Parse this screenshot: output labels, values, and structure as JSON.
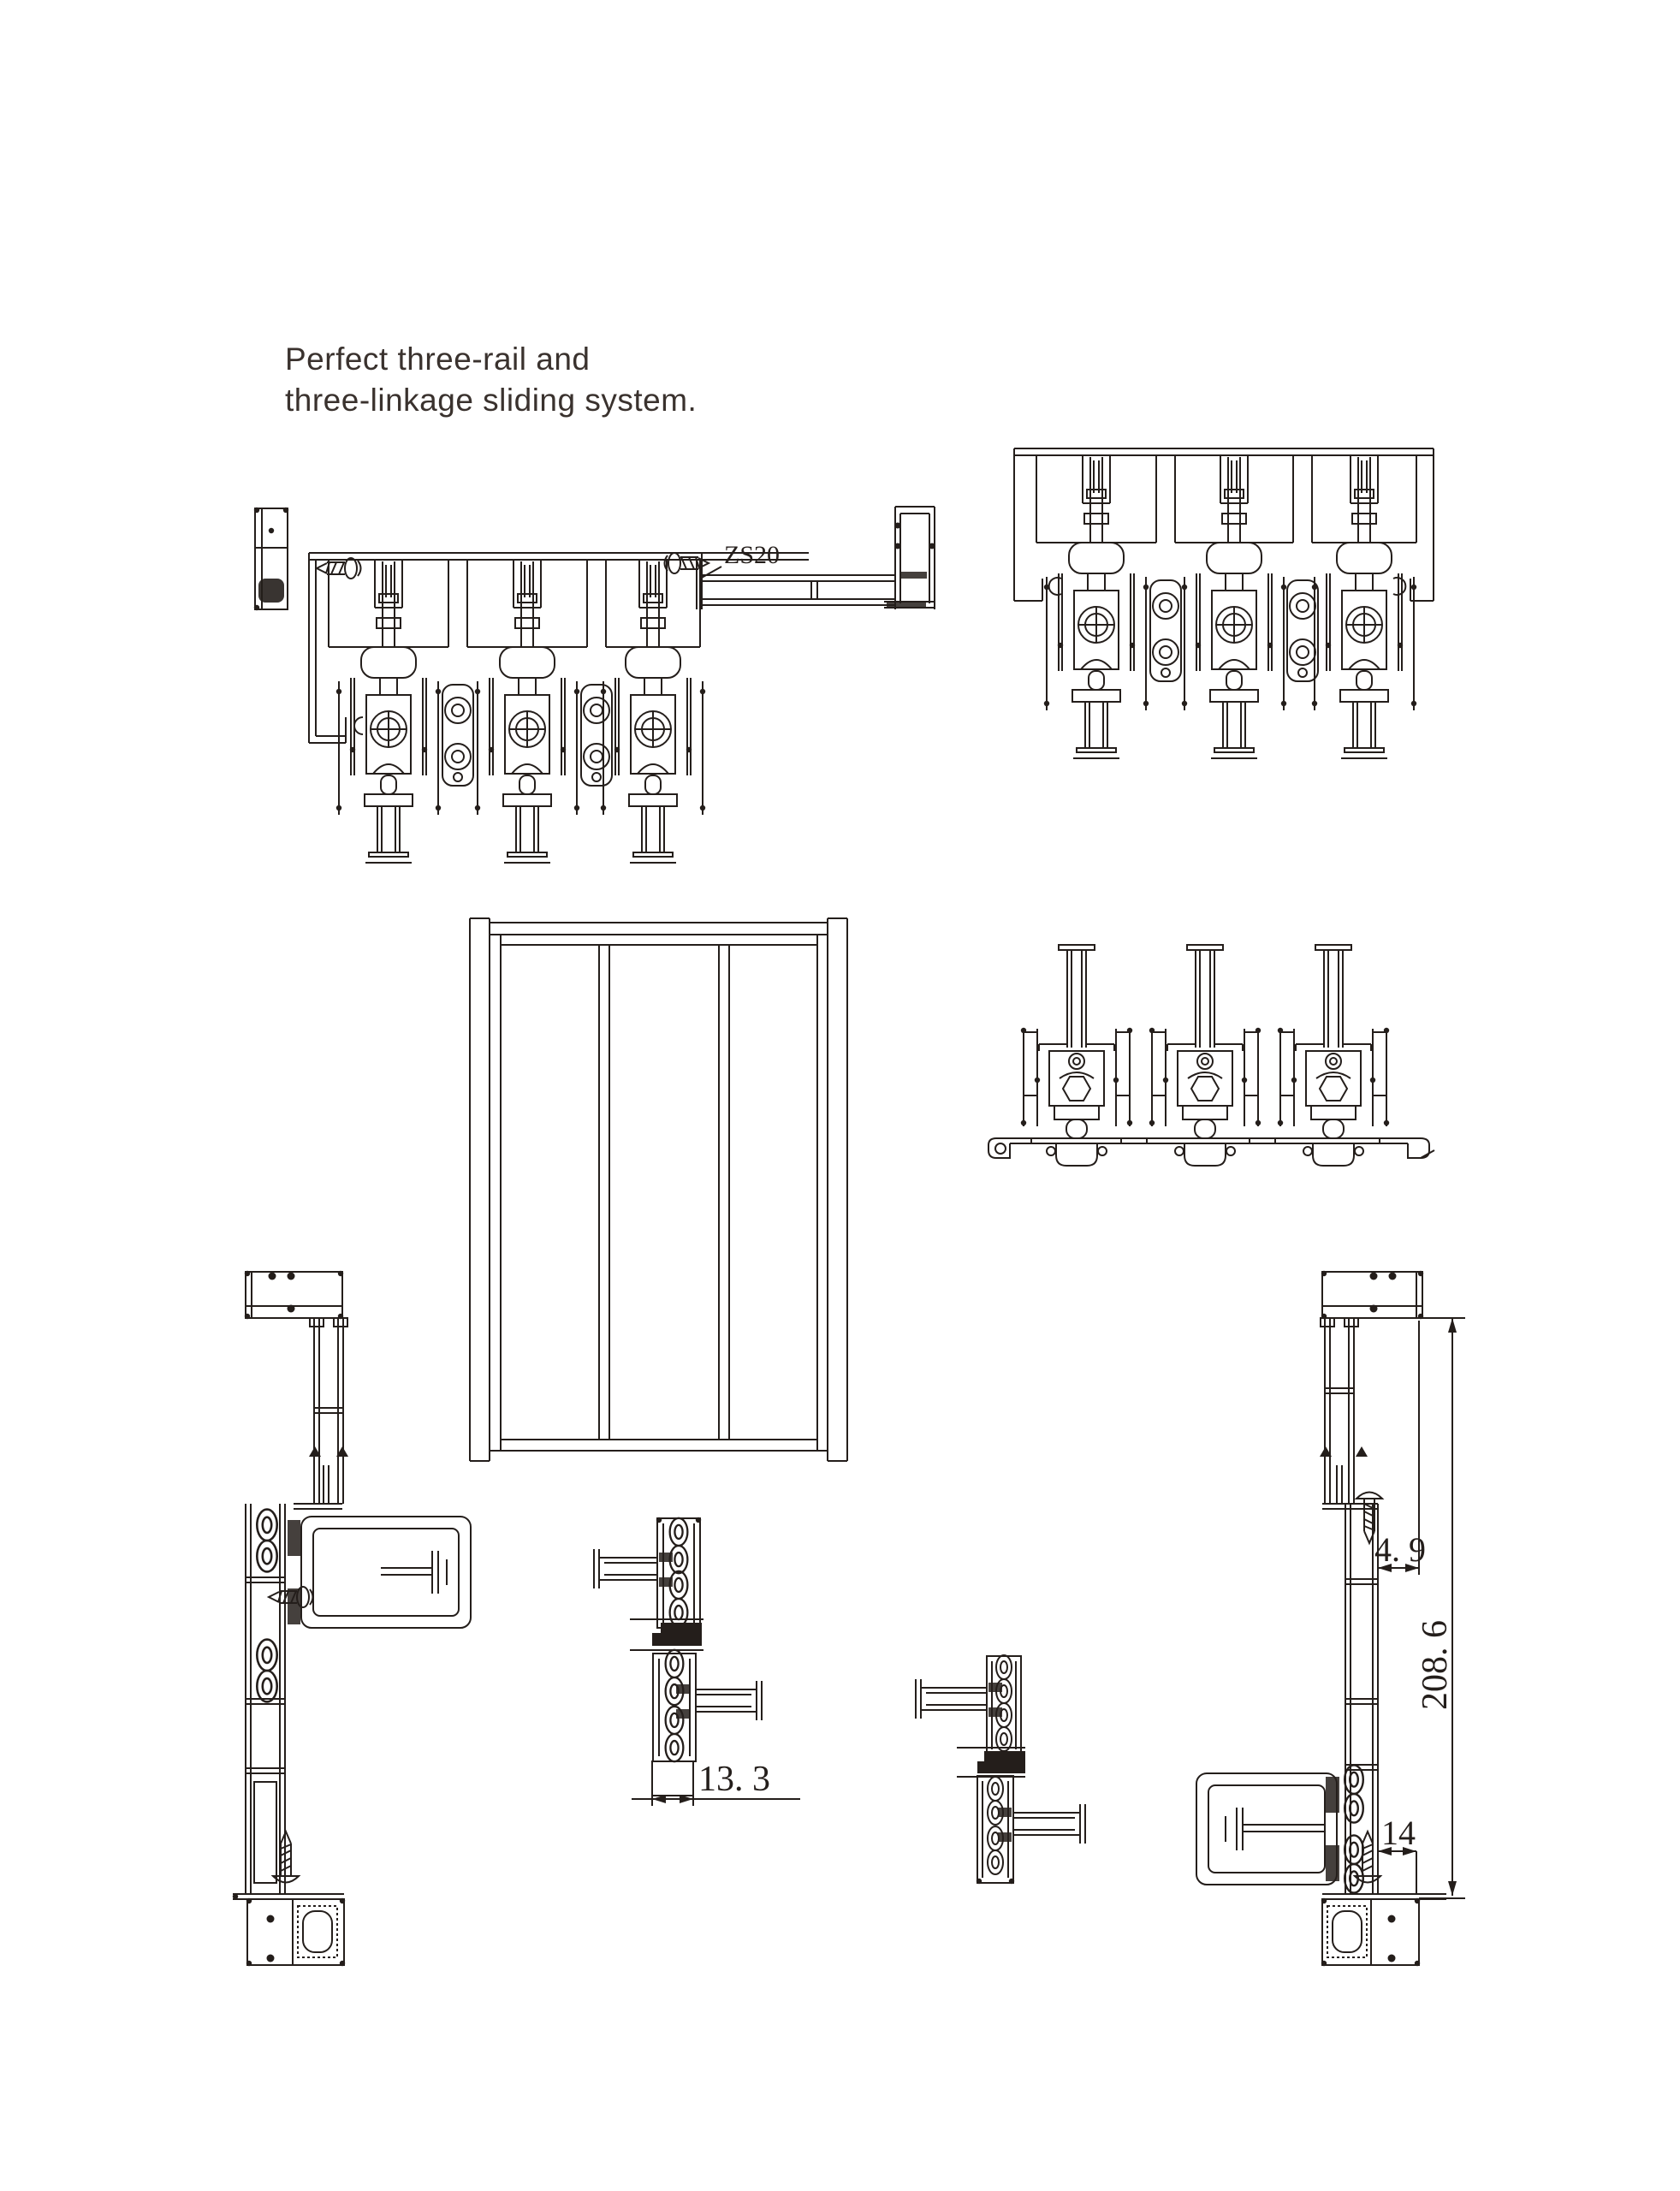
{
  "colors": {
    "ink": "#241e1b",
    "title_text": "#3a322e",
    "background": "#ffffff"
  },
  "title": {
    "line1": "Perfect three-rail and",
    "line2": "three-linkage sliding system."
  },
  "labels": {
    "part_code": "ZS20",
    "dim_interlock_width": "13. 3",
    "dim_jamb_offset": "4. 9",
    "dim_overall_height": "208. 6",
    "dim_bottom_gap": "14"
  }
}
